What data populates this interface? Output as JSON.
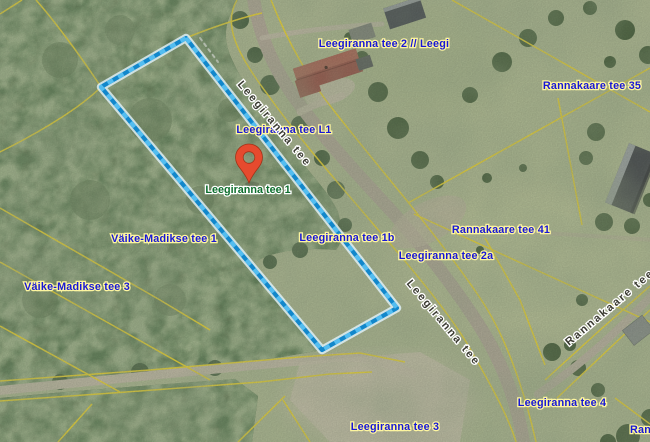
{
  "map": {
    "description": "aerial-orthophoto-cadastral-map",
    "selected_address": {
      "text": "Leegiranna tee 1"
    },
    "address_labels": [
      {
        "text": "Leegiranna tee 2 // Leegi"
      },
      {
        "text": "Leegiranna tee L1"
      },
      {
        "text": "Väike-Madikse tee 1"
      },
      {
        "text": "Väike-Madikse tee 3"
      },
      {
        "text": "Leegiranna tee 1b"
      },
      {
        "text": "Leegiranna tee 2a"
      },
      {
        "text": "Rannakaare tee 41"
      },
      {
        "text": "Rannakaare tee 35"
      },
      {
        "text": "Leegiranna tee 3"
      },
      {
        "text": "Leegiranna tee 4"
      },
      {
        "text": "Rannak"
      }
    ],
    "road_labels": [
      {
        "text": "Leegiranna tee"
      },
      {
        "text": "Leegiranna tee"
      },
      {
        "text": "Rannakaare tee"
      }
    ],
    "colors": {
      "highlight_parcel": "#1287cb",
      "cadastral_boundary": "#ecd73a",
      "marker": "#e64a2e",
      "address_label": "#1717d6",
      "selected_label": "#0d6e2d",
      "road_label": "#3a3a31"
    }
  }
}
